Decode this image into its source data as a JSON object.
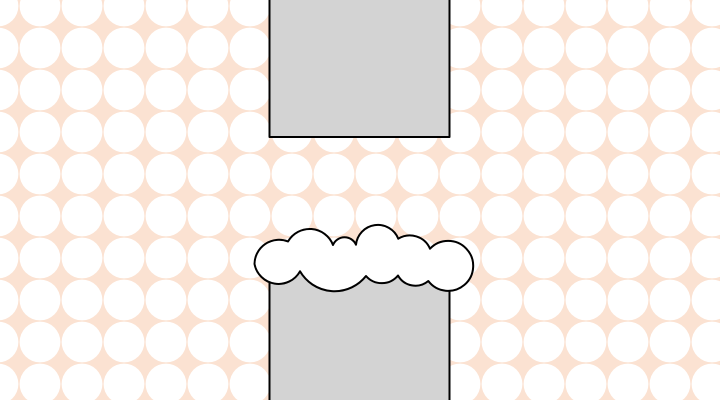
{
  "scene": {
    "label": "flappy-style obstacle scene",
    "colors": {
      "background": "#fbe2d2",
      "dots": "#ffffff",
      "pipe_fill": "#d3d3d3",
      "cloud_fill": "#ffffff",
      "outline": "#000000"
    },
    "objects": {
      "top_obstacle": "gray rectangular pipe entering from top",
      "bottom_obstacle": "gray rectangular pipe entering from bottom",
      "cloud": "white outlined cloud capping the bottom pipe"
    }
  }
}
